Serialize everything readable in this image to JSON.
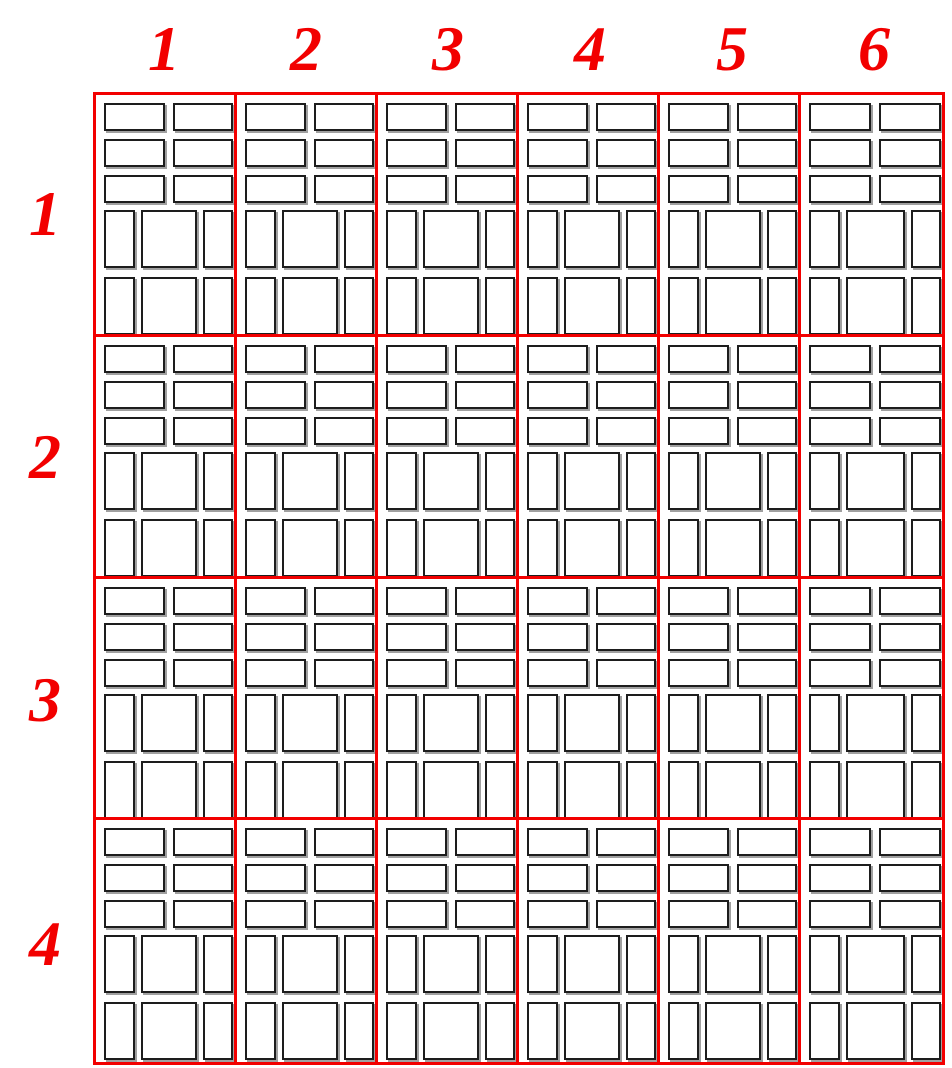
{
  "figure": {
    "description": "Grid of identical tile layout patterns",
    "column_labels": [
      "1",
      "2",
      "3",
      "4",
      "5",
      "6"
    ],
    "row_labels": [
      "1",
      "2",
      "3",
      "4"
    ],
    "rows": 4,
    "cols": 6,
    "tile": {
      "top_block": {
        "rows": 3,
        "cols": 2,
        "box_type": "wide-box"
      },
      "bottom_block": {
        "rows": 2,
        "cols": 3,
        "box_type": "tall-box"
      }
    },
    "colors": {
      "background": "#ffffff",
      "grid_line": "#f20000",
      "label_text": "#f20000",
      "box_border": "#1d1d1d",
      "box_shadow": "#a0a0a0",
      "box_fill": "#ffffff"
    }
  }
}
